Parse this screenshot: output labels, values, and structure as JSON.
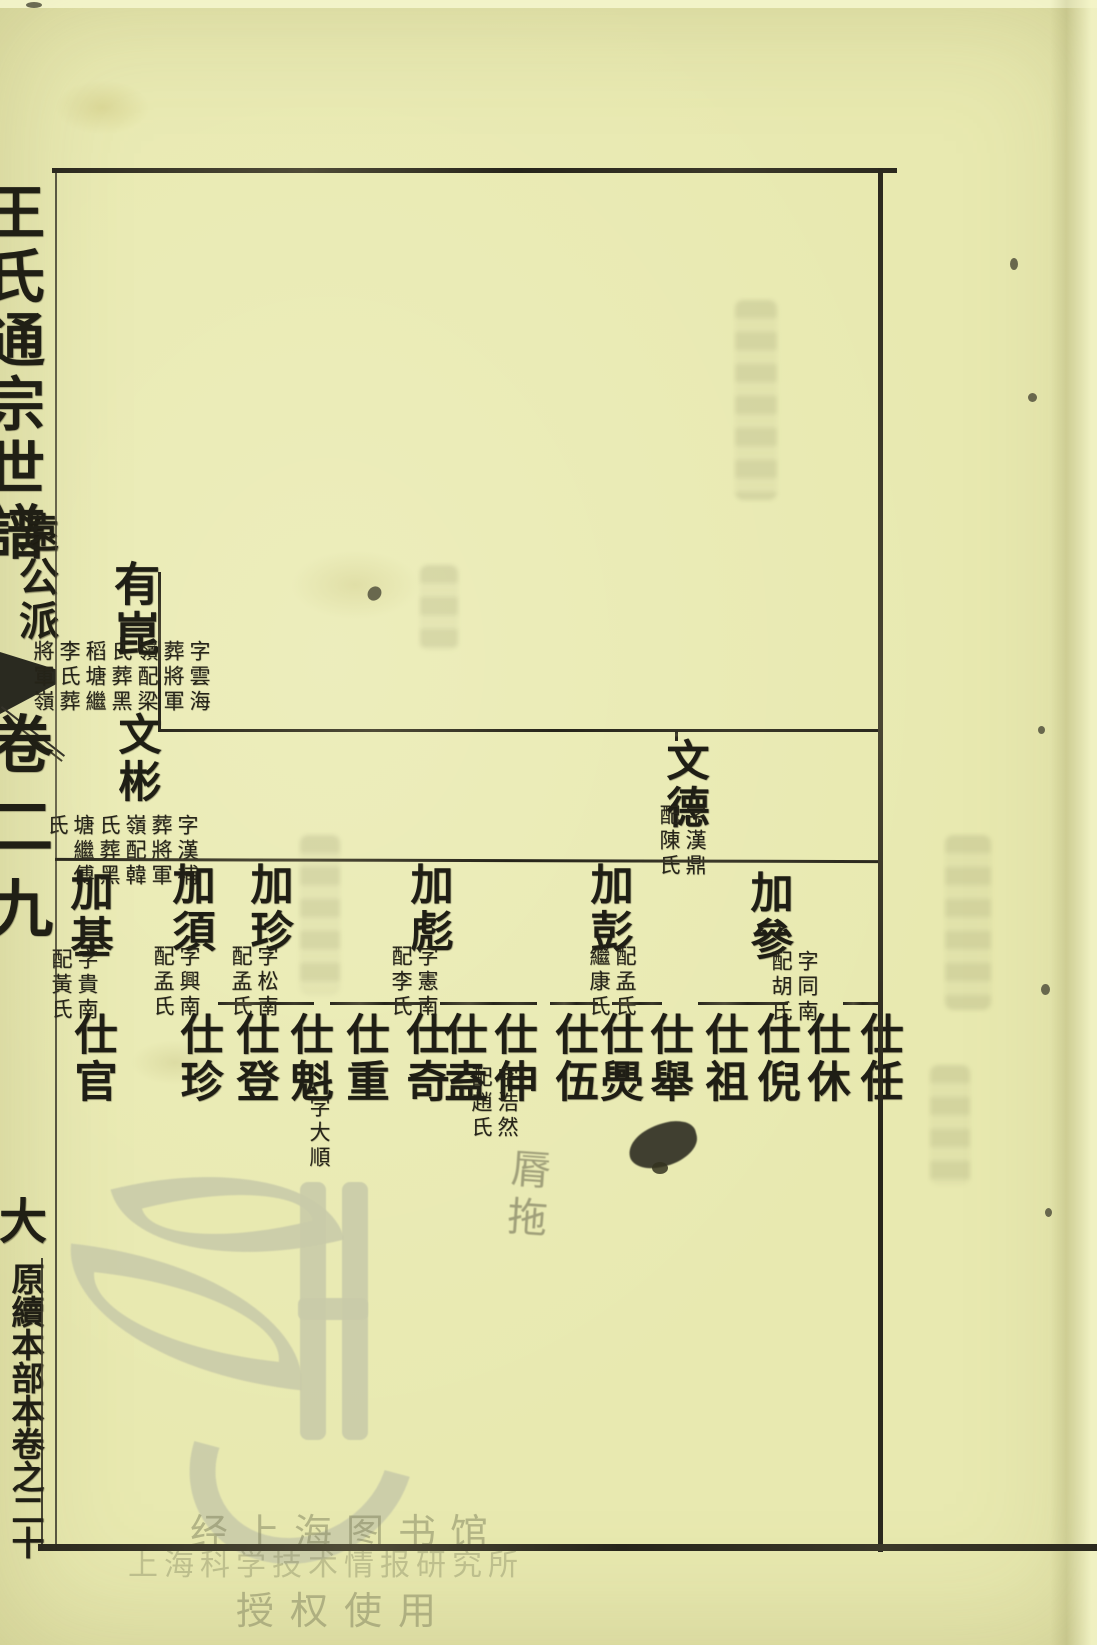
{
  "page": {
    "paper_color": "#e8e9b0",
    "ink_color": "#2b291e",
    "watermark_color": "#c9cba9"
  },
  "spine": {
    "title": "王氏通宗世譜",
    "branch": "遠公派",
    "volume_partial": "卷二九",
    "footer": "原續本部本卷之二十",
    "footer_partial_char": "大"
  },
  "tree": {
    "gen1": [
      {
        "name": "有崑",
        "note": "字雲海葬將軍嶺配梁氏葬黑稻塘繼李氏葬將軍嶺"
      }
    ],
    "gen2": [
      {
        "name": "文德",
        "note": "字漢鼎配陳氏"
      },
      {
        "name": "文彬",
        "note": "字漢補葬將軍嶺配韓氏葬黑塘繼傅氏"
      }
    ],
    "gen3": [
      {
        "name": "加參",
        "note": "字同南配胡氏"
      },
      {
        "name": "加彭",
        "note": "配孟氏繼康氏"
      },
      {
        "name": "加彪",
        "note": "字憲南配李氏"
      },
      {
        "name": "加珍",
        "note": "字松南配孟氏"
      },
      {
        "name": "加須",
        "note": "字興南配孟氏"
      },
      {
        "name": "加基",
        "note": "字貴南配黃氏"
      }
    ],
    "gen4": [
      {
        "name": "仕任",
        "note": ""
      },
      {
        "name": "仕休",
        "note": ""
      },
      {
        "name": "仕倪",
        "note": ""
      },
      {
        "name": "仕祖",
        "note": ""
      },
      {
        "name": "仕舉",
        "note": ""
      },
      {
        "name": "仕爂",
        "note": ""
      },
      {
        "name": "仕伍",
        "note": ""
      },
      {
        "name": "仕伸",
        "note": "字浩然配趙氏",
        "faint_extra": "脣拖"
      },
      {
        "name": "仕盍",
        "note": ""
      },
      {
        "name": "仕奇",
        "note": ""
      },
      {
        "name": "仕重",
        "note": ""
      },
      {
        "name": "仕魁",
        "note": "字大順"
      },
      {
        "name": "仕登",
        "note": ""
      },
      {
        "name": "仕珍",
        "note": ""
      },
      {
        "name": "仕官",
        "note": ""
      }
    ]
  },
  "watermark": {
    "line1": "经上海图书馆",
    "line2": "上海科学技术情报研究所",
    "line3": "授权使用"
  }
}
